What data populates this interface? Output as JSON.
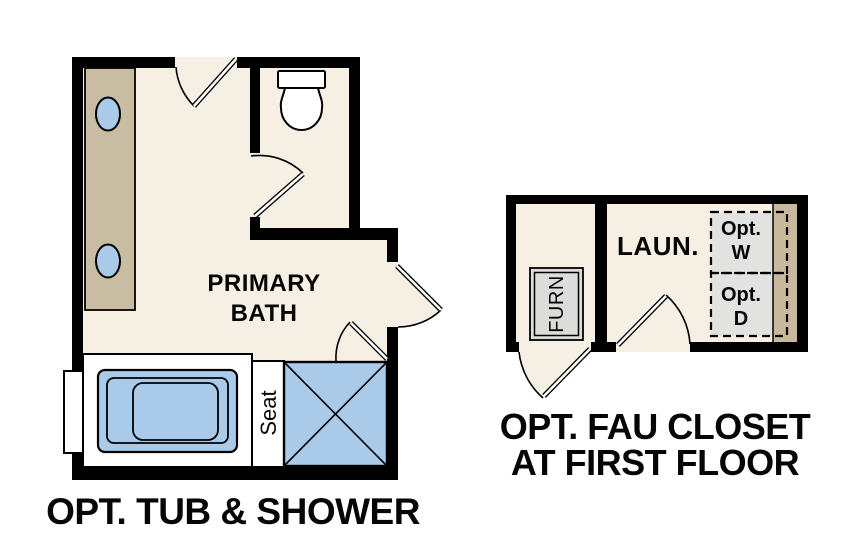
{
  "colors": {
    "wall": "#000000",
    "floor": "#f5efe4",
    "counter": "#c8bca3",
    "strip": "#c9b89c",
    "fixture_blue": "#a9cbe9",
    "appliance_gray": "#e2e2e0",
    "furnace_gray": "#dcdcda",
    "white": "#ffffff",
    "line": "#000000"
  },
  "primary_bath": {
    "room_label_line1": "PRIMARY",
    "room_label_line2": "BATH",
    "seat_label": "Seat",
    "caption": "OPT. TUB & SHOWER"
  },
  "fau_closet": {
    "room_label": "LAUN.",
    "furnace_label": "FURN",
    "washer_label_line1": "Opt.",
    "washer_label_line2": "W",
    "dryer_label_line1": "Opt.",
    "dryer_label_line2": "D",
    "caption_line1": "OPT. FAU CLOSET",
    "caption_line2": "AT FIRST FLOOR"
  }
}
